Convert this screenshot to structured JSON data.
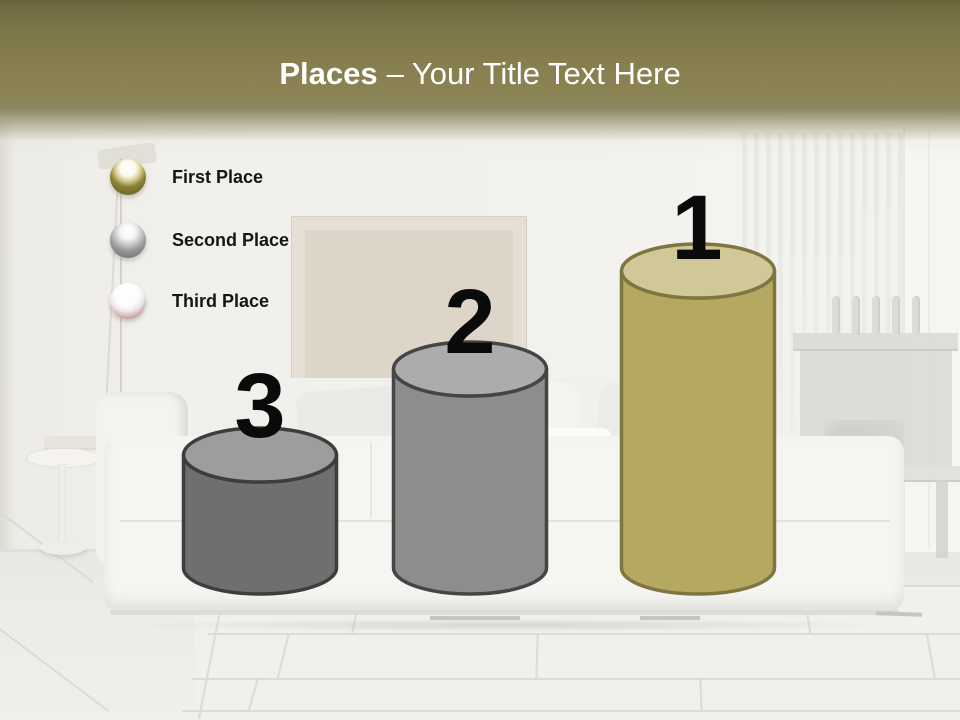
{
  "slide": {
    "width": 960,
    "height": 720,
    "header": {
      "title_bold": "Places",
      "title_rest": "– Your Title Text Here",
      "text_color": "#ffffff",
      "band_top_color": "#67623a",
      "band_mid_color": "#8a8150"
    },
    "background_scene": "faded living room photo: white sofa with pillows, beige picture frame on wall, white radiator, sheer curtain, floor lamp, round side table, dark console shelf with five figurines, large white floor tiles"
  },
  "legend": {
    "label_color": "#151515",
    "items": [
      {
        "label": "First Place",
        "sphere_style": "gold",
        "sphere_color": "#8a8035"
      },
      {
        "label": "Second Place",
        "sphere_style": "silver",
        "sphere_color": "#8c8c8c"
      },
      {
        "label": "Third Place",
        "sphere_style": "white-red",
        "sphere_color": "#9e5c5c"
      }
    ]
  },
  "diagram": {
    "type": "podium-cylinder-chart",
    "number_color": "#0a0a0a",
    "cylinders": [
      {
        "rank": "1",
        "place": "First Place",
        "relative_height_px": 298,
        "body_color": "#b5a961",
        "top_color": "#d0c896",
        "outline_color": "#7e7542"
      },
      {
        "rank": "2",
        "place": "Second Place",
        "relative_height_px": 201,
        "body_color": "#8d8d8d",
        "top_color": "#acacac",
        "outline_color": "#454545"
      },
      {
        "rank": "3",
        "place": "Third Place",
        "relative_height_px": 115,
        "body_color": "#6f6f6f",
        "top_color": "#9d9d9d",
        "outline_color": "#3d3d3d"
      }
    ]
  },
  "chart_data": {
    "type": "bar",
    "title": "Places – Your Title Text Here",
    "categories": [
      "First Place",
      "Second Place",
      "Third Place"
    ],
    "series": [
      {
        "name": "rank_label",
        "values": [
          1,
          2,
          3
        ]
      },
      {
        "name": "relative_cylinder_height",
        "values": [
          3,
          2,
          1
        ]
      }
    ],
    "legend_position": "upper-left",
    "grid": false
  }
}
